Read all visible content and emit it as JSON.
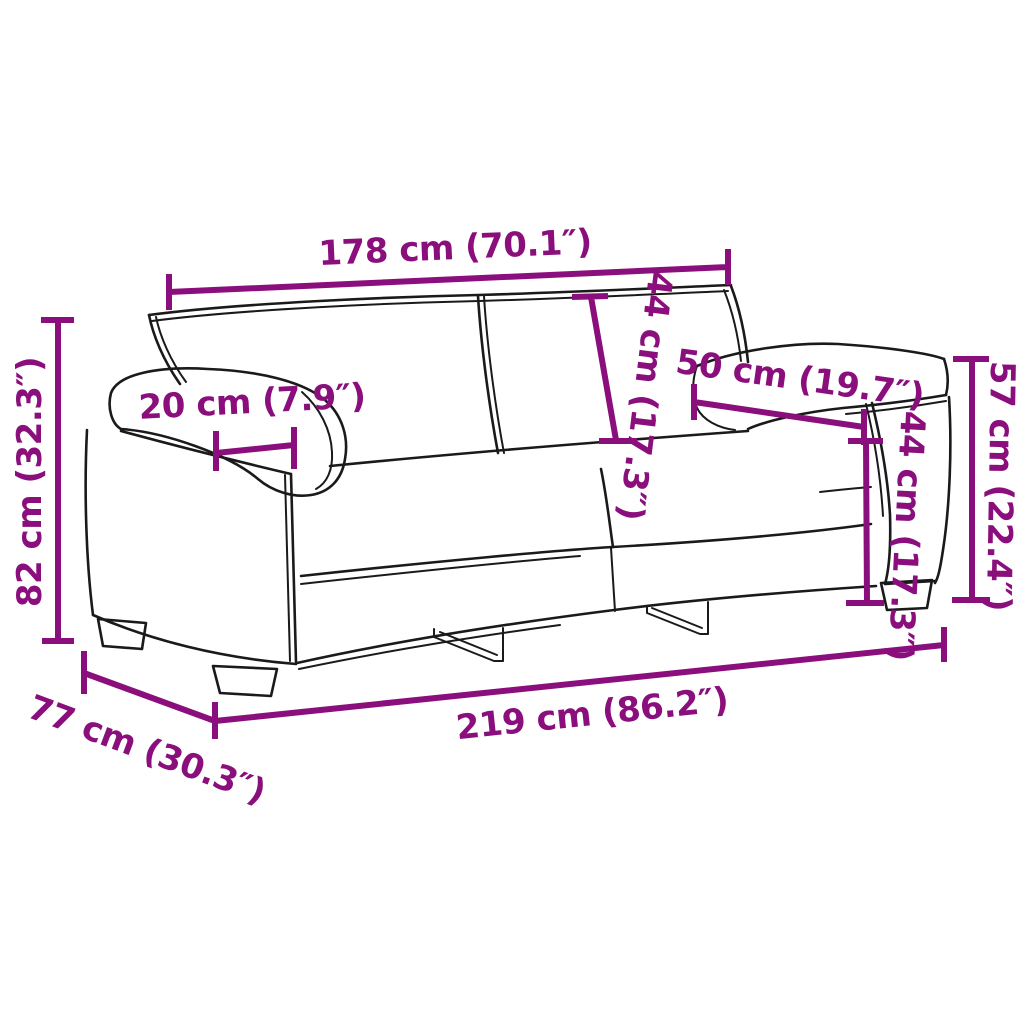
{
  "diagram": {
    "subject": "two-seater sofa dimension drawing",
    "accent_color": "#8A0F7C",
    "outline_color": "#1A1A1A",
    "background_color": "#FFFFFF",
    "labels": {
      "back_width": "178 cm (70.1″)",
      "back_height": "44 cm (17.3″)",
      "armrest_depth": "50 cm (19.7″)",
      "armrest_width": "20 cm (7.9″)",
      "overall_height": "82 cm (32.3″)",
      "arm_height": "57 cm (22.4″)",
      "seat_height": "44 cm (17.3″)",
      "overall_depth": "77 cm (30.3″)",
      "overall_width": "219 cm (86.2″)"
    }
  }
}
